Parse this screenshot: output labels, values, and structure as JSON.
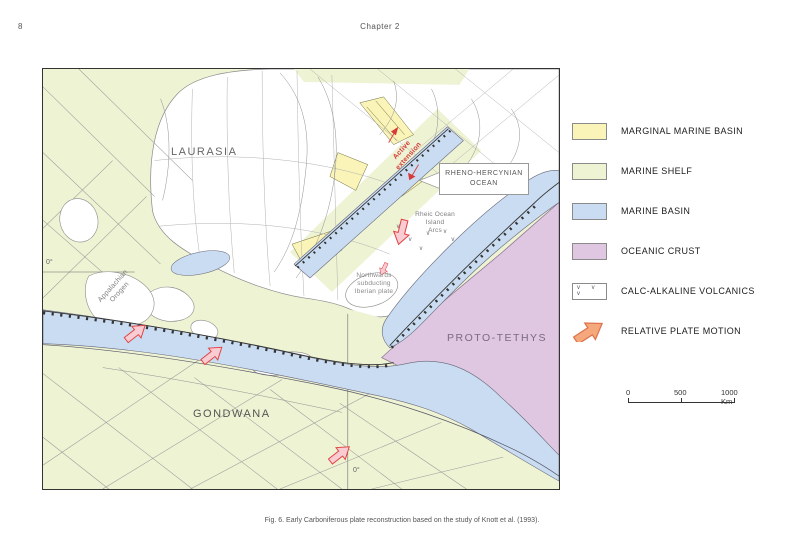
{
  "page": {
    "number": "8",
    "header": "Chapter 2",
    "caption": "Fig. 6. Early Carboniferous plate reconstruction based on the study of Knott et al. (1993)."
  },
  "map": {
    "labels": {
      "laurasia": "LAURASIA",
      "gondwana": "GONDWANA",
      "proto_tethys": "PROTO-TETHYS",
      "rheno_line1": "RHENO-HERCYNIAN",
      "rheno_line2": "OCEAN",
      "rheic_line1": "Rheic Ocean",
      "rheic_line2": "Island",
      "rheic_line3": "Arcs",
      "iberian_line1": "Northwards",
      "iberian_line2": "subducting",
      "iberian_line3": "Iberian plate",
      "appalachian_line1": "Appalachian",
      "appalachian_line2": "Orogen",
      "active_line1": "Active",
      "active_line2": "extension",
      "equator": "0°",
      "meridian": "0°"
    },
    "volcanic_mark": "v"
  },
  "legend": {
    "items": [
      {
        "label": "MARGINAL MARINE BASIN",
        "color": "#faf4b8"
      },
      {
        "label": "MARINE SHELF",
        "color": "#eef3d3"
      },
      {
        "label": "MARINE BASIN",
        "color": "#c9dcf1"
      },
      {
        "label": "OCEANIC CRUST",
        "color": "#dfc7e2"
      },
      {
        "label": "CALC-ALKALINE VOLCANICS",
        "color": "#ffffff",
        "symbol": "v v v"
      },
      {
        "label": "RELATIVE PLATE MOTION",
        "color": "#f6a87d"
      }
    ]
  },
  "scalebar": {
    "tick0": "0",
    "tick500": "500",
    "tick1000": "1000 Km"
  },
  "colors": {
    "marginal_marine_basin": "#faf4b8",
    "marine_shelf": "#eef3d3",
    "marine_basin": "#c9dcf1",
    "oceanic_crust": "#dfc7e2",
    "plate_motion_arrow": "#f6a87d",
    "map_arrow_fill": "#f9ccd4",
    "map_arrow_outline": "#e24444",
    "active_extension_text": "#d93a3a"
  }
}
